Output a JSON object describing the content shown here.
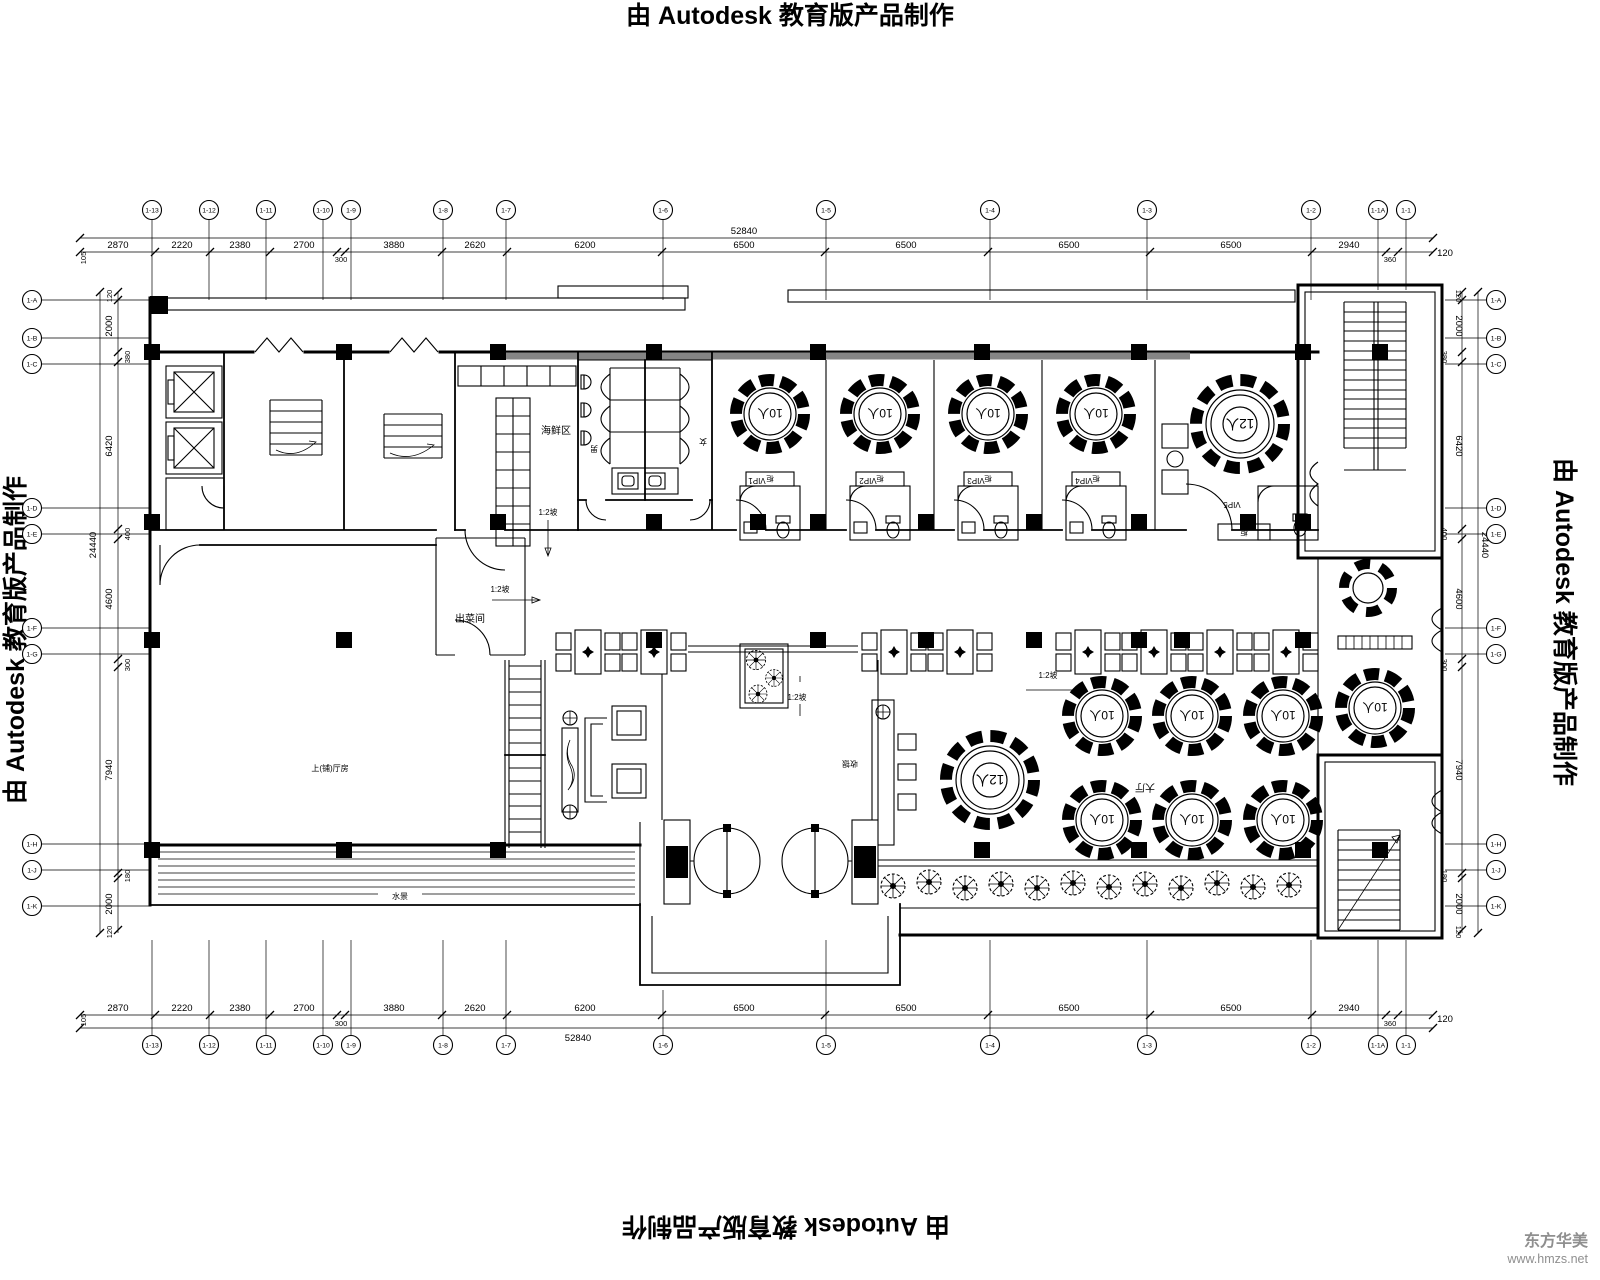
{
  "edge": {
    "autodesk": "由 Autodesk 教育版产品制作"
  },
  "watermark": {
    "name": "东方华美",
    "site": "www.hmzs.net"
  },
  "grid": {
    "top": [
      "1-13",
      "1-12",
      "1-11",
      "1-10",
      "1-9",
      "1-8",
      "1-7",
      "1-6",
      "1-5",
      "1-4",
      "1-3",
      "1-2",
      "1-1A",
      "1-1"
    ],
    "bottom": [
      "1-13",
      "1-12",
      "1-11",
      "1-10",
      "1-9",
      "1-8",
      "1-7",
      "1-6",
      "1-5",
      "1-4",
      "1-3",
      "1-2",
      "1-1A",
      "1-1"
    ],
    "left": [
      "1-A",
      "1-B",
      "1-C",
      "1-D",
      "1-E",
      "1-F",
      "1-G",
      "1-H",
      "1-J",
      "1-K"
    ],
    "right": [
      "1-A",
      "1-B",
      "1-C",
      "1-D",
      "1-E",
      "1-F",
      "1-G",
      "1-H",
      "1-J",
      "1-K"
    ]
  },
  "dims": {
    "top": [
      "105",
      "2870",
      "2220",
      "2380",
      "2700",
      "300",
      "3880",
      "2620",
      "6200",
      "6500",
      "6500",
      "6500",
      "6500",
      "2940",
      "360",
      "120"
    ],
    "top_total": "52840",
    "bottom": [
      "105",
      "2870",
      "2220",
      "2380",
      "2700",
      "300",
      "3880",
      "2620",
      "6200",
      "6500",
      "6500",
      "6500",
      "6500",
      "2940",
      "360",
      "120"
    ],
    "bottom_total": "52840",
    "left": [
      "120",
      "2000",
      "380",
      "6420",
      "400",
      "4600",
      "300",
      "7940",
      "180",
      "2000",
      "120"
    ],
    "left_total": "24440",
    "right": [
      "120",
      "2000",
      "380",
      "6420",
      "400",
      "4600",
      "300",
      "7940",
      "180",
      "2000",
      "120"
    ],
    "right_total": "24440"
  },
  "labels": {
    "seafood": "海鲜区",
    "dish": "出菜间",
    "slope": "1:2坡",
    "men": "男",
    "women": "女",
    "vip1": "VIP1",
    "vip2": "VIP2",
    "vip3": "VIP3",
    "vip4": "VIP4",
    "vip5": "VIP5",
    "cabinet": "柜",
    "hall": "大厅",
    "cashier": "收银",
    "water": "水景",
    "left_room": "上(铺)厅房",
    "t10": "10人",
    "t12": "12人"
  }
}
